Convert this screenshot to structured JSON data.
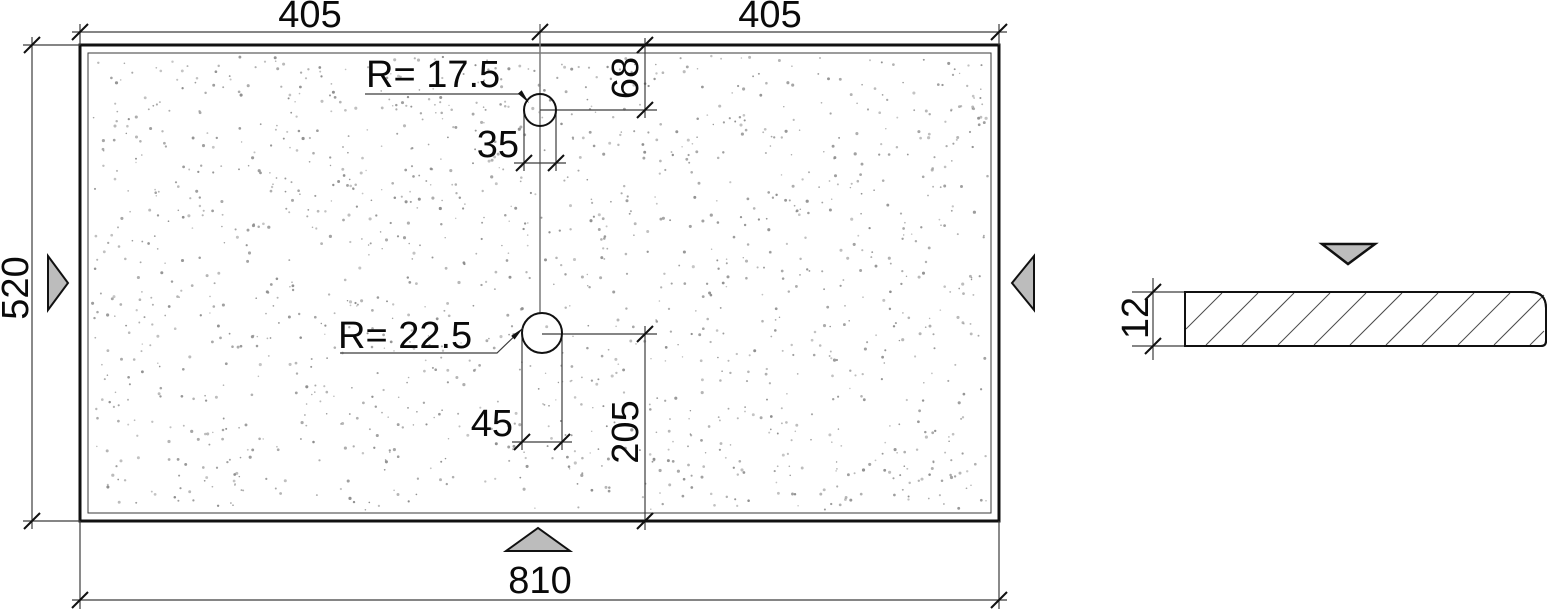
{
  "views": {
    "plan": {
      "dim_top_left": "405",
      "dim_top_right": "405",
      "dim_height": "520",
      "dim_width": "810",
      "hole_top": {
        "radius_label": "R= 17.5",
        "width_label": "35",
        "offset_from_top": "68"
      },
      "hole_bottom": {
        "radius_label": "R= 22.5",
        "width_label": "45",
        "offset_from_bottom": "205"
      }
    },
    "section": {
      "thickness": "12"
    }
  },
  "colors": {
    "line": "#111111",
    "dim_line": "#3c3c3c",
    "centerline": "#7a7a7a",
    "triangle_fill": "#bcbcbc",
    "dot": "#8e8e8e",
    "background": "#ffffff"
  }
}
